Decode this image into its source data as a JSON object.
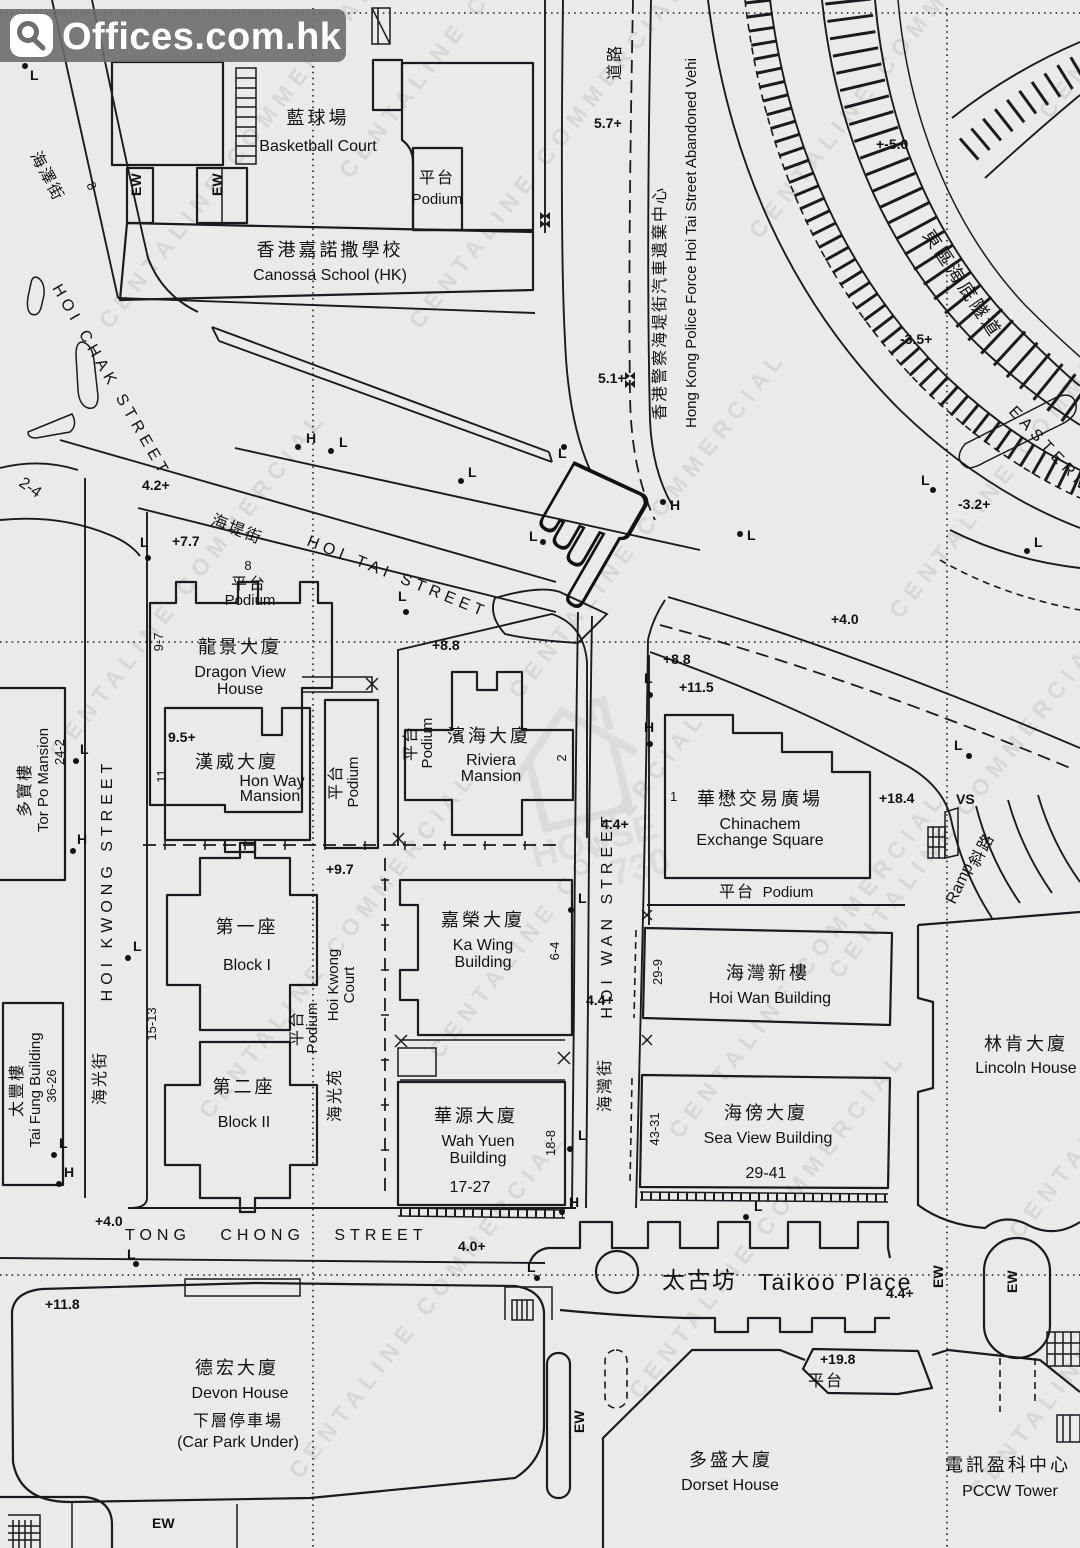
{
  "logo": {
    "brand": "Offices.com.hk"
  },
  "watermarks": {
    "diagonal": "CENTALINE COMMERCIAL",
    "center_top": "HOUSE",
    "center_bottom": "730",
    "positions": [
      [
        110,
        330
      ],
      [
        60,
        760
      ],
      [
        210,
        1120
      ],
      [
        300,
        1480
      ],
      [
        420,
        330
      ],
      [
        520,
        700
      ],
      [
        440,
        1060
      ],
      [
        640,
        1400
      ],
      [
        760,
        240
      ],
      [
        900,
        620
      ],
      [
        840,
        980
      ],
      [
        1020,
        1240
      ],
      [
        980,
        1500
      ],
      [
        1050,
        120
      ],
      [
        350,
        180
      ],
      [
        680,
        1140
      ]
    ]
  },
  "streets": {
    "hoi_chak": {
      "zh": "海澤街",
      "en": "HOI CHAK STREET"
    },
    "hoi_tai": {
      "zh": "海堤街",
      "en": "HOI TAI STREET"
    },
    "hoi_kwong": {
      "zh": "海光街",
      "en": "HOI KWONG STREET"
    },
    "hoi_wan": {
      "zh": "海灣街",
      "en": "HOI WAN STREET"
    },
    "tong_chong": {
      "en": "TONG CHONG STREET"
    },
    "taikoo": {
      "zh": "太古坊",
      "en": "Taikoo Place"
    },
    "road_zh": "道路",
    "ramp": {
      "en": "Ramp",
      "zh": "斜路"
    }
  },
  "podium": {
    "zh": "平台",
    "en": "Podium"
  },
  "buildings": {
    "basketball": {
      "zh": "藍球場",
      "en": "Basketball Court"
    },
    "canossa": {
      "zh": "香港嘉諾撒學校",
      "en": "Canossa School (HK)"
    },
    "police": {
      "zh": "香港警察海堤街汽車遺棄中心",
      "en": "Hong Kong Police Force Hoi Tai Street Abandoned Vehi"
    },
    "tunnel": {
      "zh": "東區海底隧道",
      "en": "EASTERN"
    },
    "dragon_view": {
      "zh": "龍景大廈",
      "en1": "Dragon View",
      "en2": "House",
      "lot": "9-7",
      "num8": "8"
    },
    "hon_way": {
      "zh": "漢威大廈",
      "en1": "Hon Way",
      "en2": "Mansion",
      "lot": "11"
    },
    "riviera": {
      "zh": "濱海大廈",
      "en1": "Riviera",
      "en2": "Mansion",
      "lot": "2"
    },
    "chinachem": {
      "zh": "華懋交易廣場",
      "en1": "Chinachem",
      "en2": "Exchange Square",
      "lot": "1"
    },
    "tor_po": {
      "zh": "多寶樓",
      "en": "Tor Po Mansion",
      "nums": "24-2"
    },
    "block1": {
      "zh": "第一座",
      "en": "Block I",
      "lot": "15-13"
    },
    "block2": {
      "zh": "第二座",
      "en": "Block II"
    },
    "hk_court": {
      "zh": "海光苑",
      "en1": "Hoi Kwong",
      "en2": "Court"
    },
    "tai_fung": {
      "zh": "太豐樓",
      "en": "Tai Fung Building",
      "nums": "36-26"
    },
    "ka_wing": {
      "zh": "嘉榮大廈",
      "en1": "Ka Wing",
      "en2": "Building",
      "lot": "6-4"
    },
    "wah_yuen": {
      "zh": "華源大廈",
      "en1": "Wah Yuen",
      "en2": "Building",
      "nums": "17-27",
      "lot": "18-8"
    },
    "hoi_wan_bldg": {
      "zh": "海灣新樓",
      "en": "Hoi Wan Building",
      "lot": "29-9"
    },
    "sea_view": {
      "zh": "海傍大廈",
      "en": "Sea View Building",
      "nums": "29-41",
      "lot": "43-31"
    },
    "lincoln": {
      "zh": "林肯大廈",
      "en": "Lincoln House"
    },
    "devon": {
      "zh": "德宏大廈",
      "en": "Devon House",
      "sub_zh": "下層停車場",
      "sub_en": "(Car Park Under)"
    },
    "dorset": {
      "zh": "多盛大廈",
      "en": "Dorset House"
    },
    "pccw": {
      "zh": "電訊盈科中心",
      "en": "PCCW Tower"
    },
    "corner_lot": "2-4",
    "chak8": "8"
  },
  "spots": [
    {
      "t": "5.7+",
      "x": 594,
      "y": 128
    },
    {
      "t": "5.1+",
      "x": 598,
      "y": 383
    },
    {
      "t": "+-5.0",
      "x": 876,
      "y": 149
    },
    {
      "t": "-3.5+",
      "x": 900,
      "y": 344
    },
    {
      "t": "-3.2+",
      "x": 958,
      "y": 509
    },
    {
      "t": "4.2+",
      "x": 142,
      "y": 490
    },
    {
      "t": "+7.7",
      "x": 172,
      "y": 546
    },
    {
      "t": "+8.8",
      "x": 432,
      "y": 650
    },
    {
      "t": "+8.8",
      "x": 663,
      "y": 664
    },
    {
      "t": "+11.5",
      "x": 679,
      "y": 692
    },
    {
      "t": "+18.4",
      "x": 879,
      "y": 803
    },
    {
      "t": "9.5+",
      "x": 168,
      "y": 742
    },
    {
      "t": "+9.7",
      "x": 326,
      "y": 874
    },
    {
      "t": "4.4+",
      "x": 601,
      "y": 829
    },
    {
      "t": "4.4+",
      "x": 586,
      "y": 1005
    },
    {
      "t": "+4.0",
      "x": 831,
      "y": 624
    },
    {
      "t": "4.0+",
      "x": 458,
      "y": 1251
    },
    {
      "t": "+4.0",
      "x": 95,
      "y": 1226
    },
    {
      "t": "+11.8",
      "x": 45,
      "y": 1309
    },
    {
      "t": "+19.8",
      "x": 820,
      "y": 1364
    },
    {
      "t": "4.4+",
      "x": 886,
      "y": 1298
    }
  ],
  "markers": [
    {
      "t": "L",
      "x": 30,
      "y": 80,
      "d": [
        25,
        66
      ]
    },
    {
      "t": "L",
      "x": 140,
      "y": 547,
      "d": [
        148,
        558
      ]
    },
    {
      "t": "L",
      "x": 398,
      "y": 601,
      "d": [
        406,
        612
      ]
    },
    {
      "t": "L",
      "x": 468,
      "y": 477,
      "d": [
        461,
        481
      ]
    },
    {
      "t": "L",
      "x": 558,
      "y": 458,
      "d": [
        564,
        447
      ]
    },
    {
      "t": "L",
      "x": 529,
      "y": 541,
      "d": [
        543,
        542
      ]
    },
    {
      "t": "L",
      "x": 747,
      "y": 540,
      "d": [
        740,
        534
      ]
    },
    {
      "t": "L",
      "x": 921,
      "y": 485,
      "d": [
        933,
        490
      ]
    },
    {
      "t": "L",
      "x": 1034,
      "y": 547,
      "d": [
        1027,
        551
      ]
    },
    {
      "t": "L",
      "x": 644,
      "y": 683,
      "d": [
        650,
        695
      ]
    },
    {
      "t": "L",
      "x": 954,
      "y": 750,
      "d": [
        969,
        756
      ]
    },
    {
      "t": "L",
      "x": 578,
      "y": 903,
      "d": [
        571,
        910
      ]
    },
    {
      "t": "L",
      "x": 578,
      "y": 1140,
      "d": [
        570,
        1149
      ]
    },
    {
      "t": "L",
      "x": 59,
      "y": 1148,
      "d": [
        54,
        1155
      ]
    },
    {
      "t": "L",
      "x": 80,
      "y": 754,
      "d": [
        76,
        761
      ]
    },
    {
      "t": "L",
      "x": 133,
      "y": 951,
      "d": [
        128,
        958
      ]
    },
    {
      "t": "L",
      "x": 127,
      "y": 1259,
      "d": [
        136,
        1264
      ]
    },
    {
      "t": "L",
      "x": 527,
      "y": 1272,
      "d": [
        537,
        1278
      ]
    },
    {
      "t": "L",
      "x": 754,
      "y": 1211,
      "d": [
        746,
        1217
      ]
    },
    {
      "t": "L",
      "x": 339,
      "y": 447,
      "d": [
        331,
        451
      ]
    },
    {
      "t": "H",
      "x": 306,
      "y": 443,
      "d": [
        298,
        447
      ]
    },
    {
      "t": "H",
      "x": 670,
      "y": 510,
      "d": [
        663,
        502
      ]
    },
    {
      "t": "H",
      "x": 644,
      "y": 732,
      "d": [
        650,
        744
      ]
    },
    {
      "t": "H",
      "x": 569,
      "y": 1207,
      "d": [
        562,
        1212
      ]
    },
    {
      "t": "H",
      "x": 64,
      "y": 1177,
      "d": [
        59,
        1184
      ]
    },
    {
      "t": "H",
      "x": 77,
      "y": 844,
      "d": [
        73,
        851
      ]
    },
    {
      "t": "EW",
      "x": 141,
      "y": 196,
      "r": -90
    },
    {
      "t": "EW",
      "x": 222,
      "y": 196,
      "r": -90
    },
    {
      "t": "EW",
      "x": 584,
      "y": 1433,
      "r": -90
    },
    {
      "t": "EW",
      "x": 943,
      "y": 1288,
      "r": -90
    },
    {
      "t": "EW",
      "x": 1017,
      "y": 1293,
      "r": -90
    },
    {
      "t": "EW",
      "x": 152,
      "y": 1528
    },
    {
      "t": "VS",
      "x": 956,
      "y": 804
    }
  ]
}
